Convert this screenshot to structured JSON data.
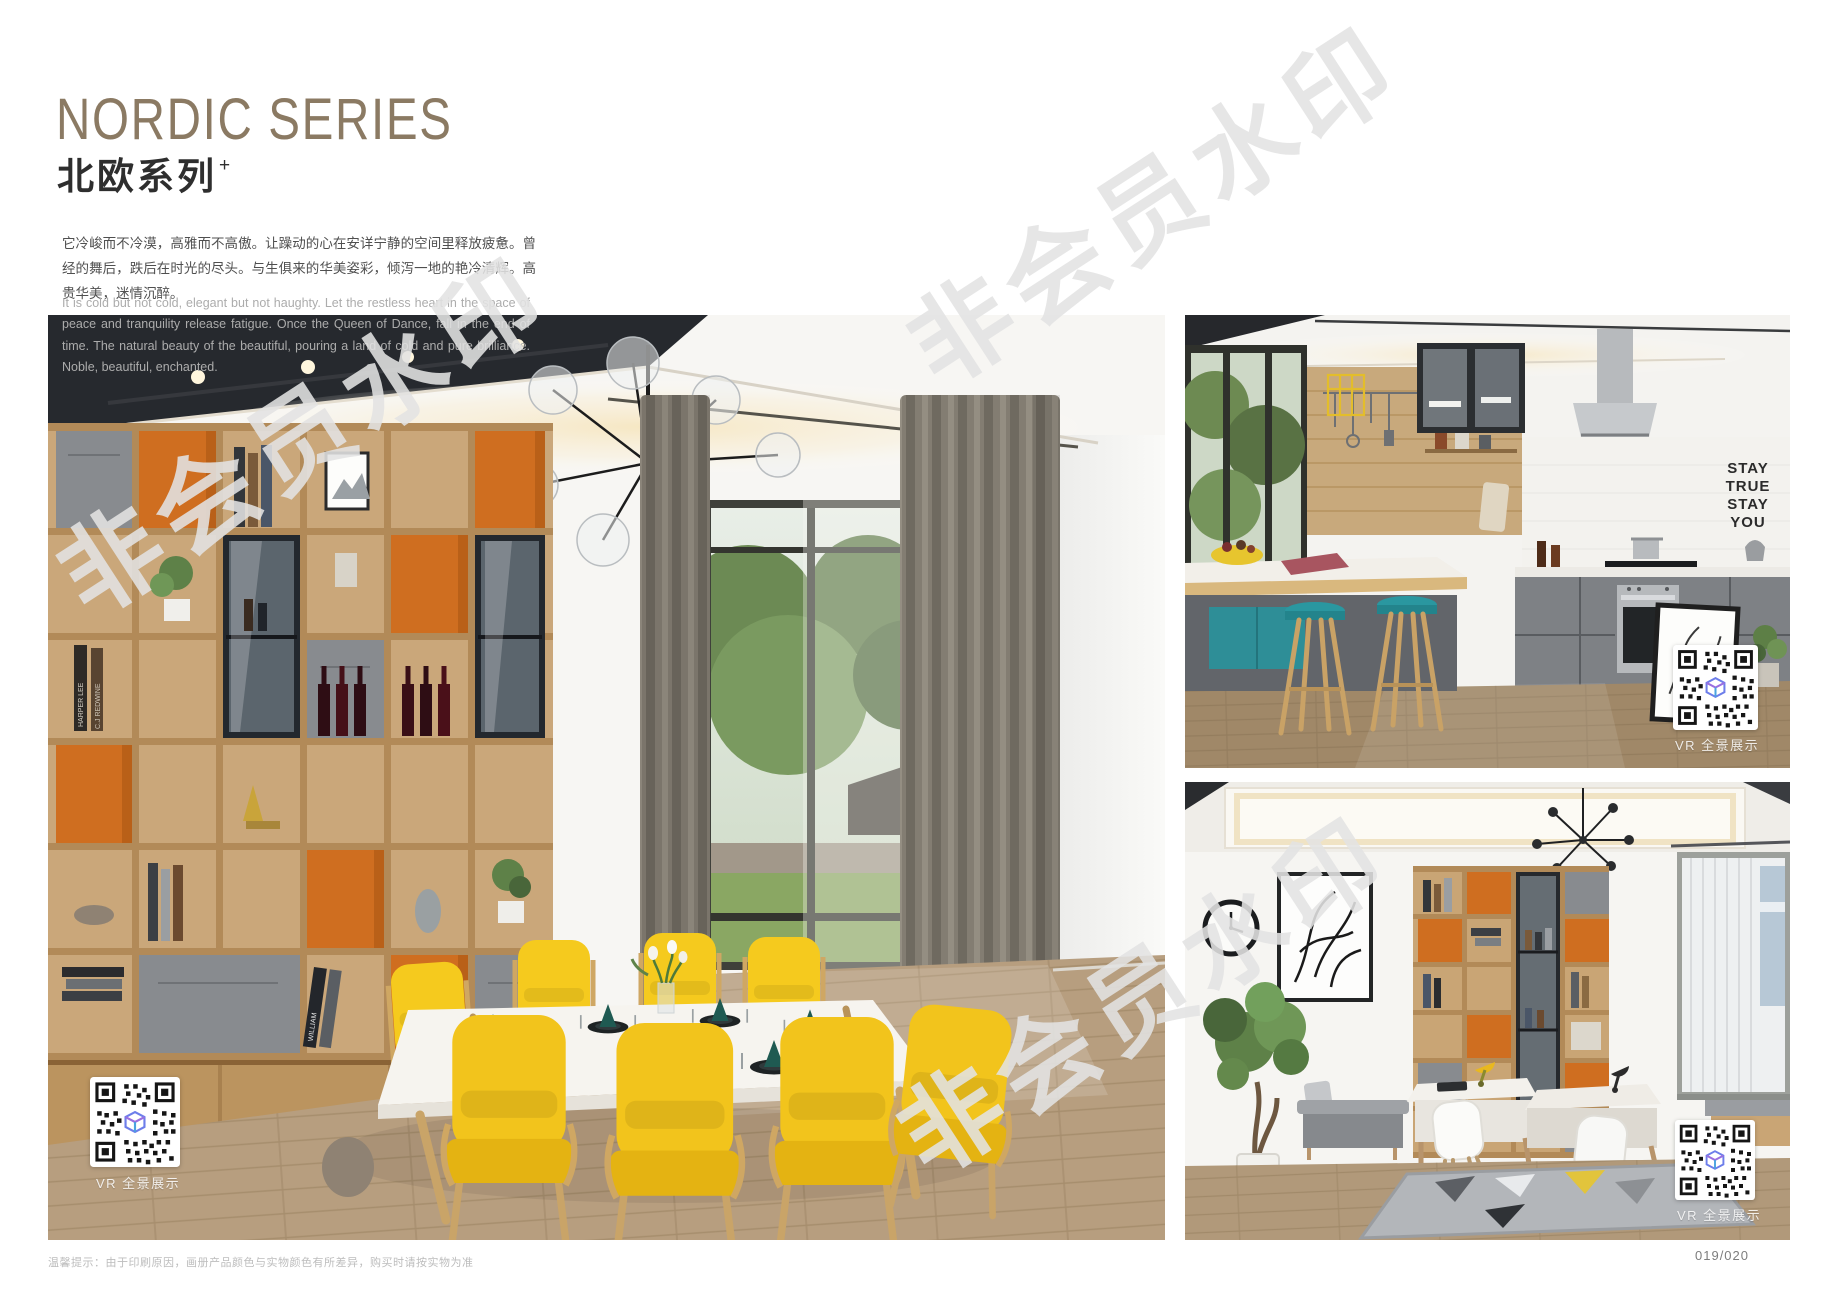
{
  "header": {
    "title_en": "NORDIC SERIES",
    "title_zh": "北欧系列",
    "title_sup": "+",
    "intro_zh": "它冷峻而不冷漠，高雅而不高傲。让躁动的心在安详宁静的空间里释放疲惫。曾经的舞后，跌后在时光的尽头。与生俱来的华美姿彩，倾泻一地的艳冷清辉。高贵华美，迷情沉醉。",
    "intro_en": "It is cold but not cold, elegant but not haughty. Let the restless heart in the space of peace and tranquility release fatigue. Once the Queen of Dance, fall in the end of time. The natural beauty of the beautiful, pouring a land of cold and pure brilliance. Noble, beautiful, enchanted."
  },
  "watermark": {
    "text": "非会员水印"
  },
  "photos": {
    "dining": {
      "caption": "VR 全景展示",
      "book_spines": [
        "HARPER LEE",
        "C.J REDWINE",
        "WILLIAM",
        "RESTORATION"
      ]
    },
    "kitchen": {
      "caption": "VR 全景展示",
      "wall_text": [
        "STAY",
        "TRUE",
        "STAY",
        "YOU"
      ]
    },
    "study": {
      "caption": "VR 全景展示"
    }
  },
  "footer": {
    "note": "温馨提示：由于印刷原因，画册产品颜色与实物颜色有所差异，购买时请按实物为准",
    "page_number": "019/020"
  },
  "colors": {
    "title": "#8b7a63",
    "accent_orange": "#cf6e20",
    "chair_yellow": "#f2c41c",
    "stool_teal": "#2a97a0",
    "wood": "#caa77a"
  }
}
